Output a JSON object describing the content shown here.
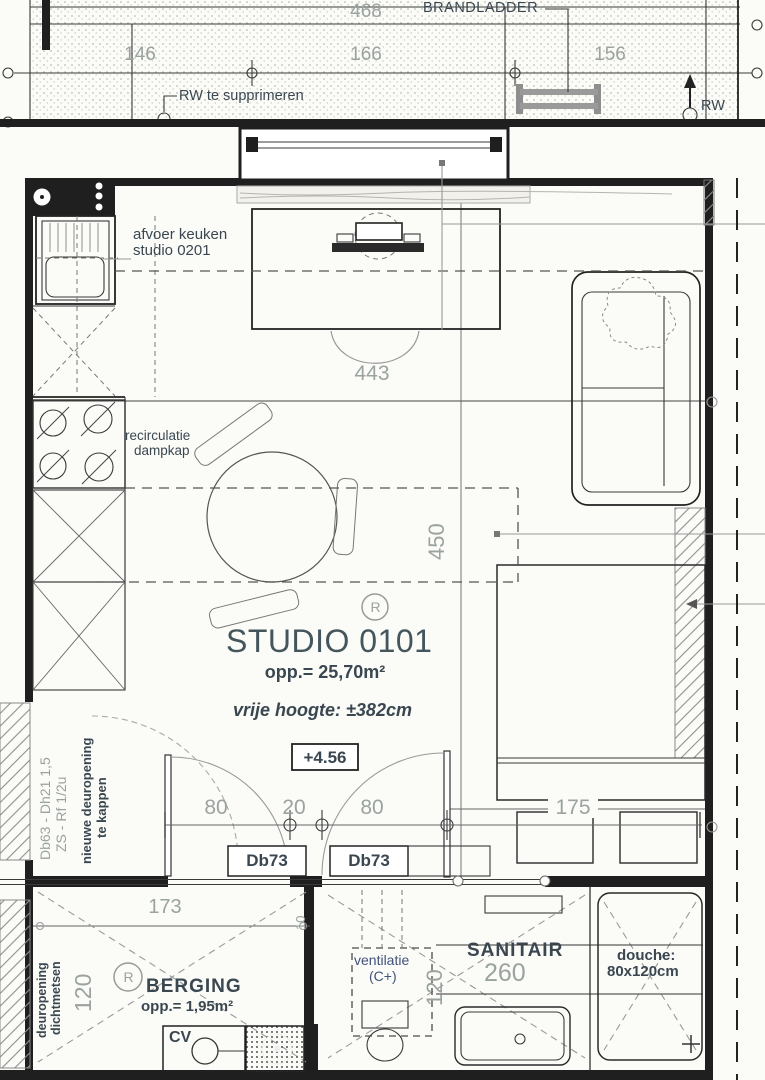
{
  "colors": {
    "wall": "#1f1f1f",
    "dim": "#9aa39f",
    "label": "#3a4750",
    "title": "#44565c",
    "blue": "#43517c",
    "paper": "#fbfbf8"
  },
  "terrace": {
    "dim_total": "468",
    "brandladder": "BRANDLADDER",
    "dim_left": "146",
    "dim_mid": "166",
    "dim_right": "156",
    "rw_note": "RW te supprimeren",
    "rw": "RW"
  },
  "kitchen": {
    "afvoer_line1": "afvoer keuken",
    "afvoer_line2": "studio 0201",
    "dampkap_line1": "recirculatie",
    "dampkap_line2": "dampkap"
  },
  "studio": {
    "r_symbol": "R",
    "title": "STUDIO 0101",
    "area": "opp.= 25,70m²",
    "height_note": "vrije hoogte: ±382cm",
    "level": "+4.56",
    "dim_desk": "443",
    "dim_depth": "450",
    "dim_bed": "175",
    "door_dim_left": "80",
    "door_dim_mid": "20",
    "door_dim_right": "80",
    "door_code_left": "Db73",
    "door_code_right": "Db73",
    "wall_note_line1": "Db63 - Dh21 1,5",
    "wall_note_line2": "ZS - Rf 1/2u",
    "door_note_line1": "nieuwe deuropening",
    "door_note_line2": "te kappen"
  },
  "berging": {
    "r_symbol": "R",
    "name": "BERGING",
    "area": "opp.= 1,95m²",
    "cv": "CV",
    "dim_width": "173",
    "dim_small": "10",
    "dim_depth": "120",
    "wall_note_line1": "deuropening",
    "wall_note_line2": "dichtmetsen"
  },
  "sanitair": {
    "name": "SANITAIR",
    "dim_length": "260",
    "dim_depth": "120",
    "vent_line1": "ventilatie",
    "vent_line2": "(C+)",
    "douche_line1": "douche:",
    "douche_line2": "80x120cm"
  }
}
